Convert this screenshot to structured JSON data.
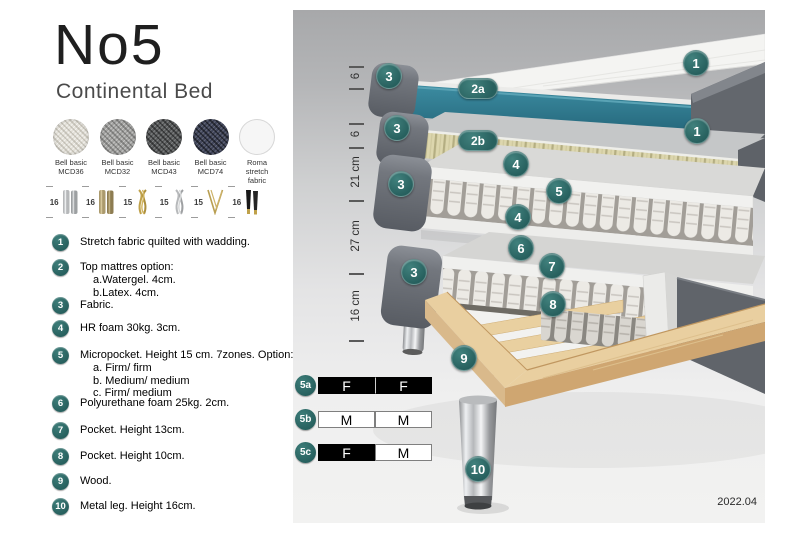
{
  "header": {
    "title": "No5",
    "subtitle": "Continental Bed"
  },
  "fabrics": [
    {
      "name": "Bell basic",
      "code": "MCD36"
    },
    {
      "name": "Bell basic",
      "code": "MCD32"
    },
    {
      "name": "Bell basic",
      "code": "MCD43"
    },
    {
      "name": "Bell basic",
      "code": "MCD74"
    },
    {
      "name": "Roma",
      "code": "stretch fabric"
    }
  ],
  "legs": [
    {
      "height": "16",
      "style": "chrome cylinder"
    },
    {
      "height": "16",
      "style": "bronze cylinder"
    },
    {
      "height": "15",
      "style": "gold twist"
    },
    {
      "height": "15",
      "style": "silver twist"
    },
    {
      "height": "15",
      "style": "gold hairpin"
    },
    {
      "height": "16",
      "style": "black with gold tip"
    }
  ],
  "list": [
    {
      "num": "1",
      "text": "Stretch fabric quilted with wadding."
    },
    {
      "num": "2",
      "text": "Top mattres option:",
      "sub": [
        "a.Watergel. 4cm.",
        "b.Latex. 4cm."
      ]
    },
    {
      "num": "3",
      "text": "Fabric."
    },
    {
      "num": "4",
      "text": "HR foam 30kg. 3cm."
    },
    {
      "num": "5",
      "text": "Micropocket. Height 15 cm. 7zones. Option:",
      "sub": [
        "a. Firm/ firm",
        "b. Medium/ medium",
        "c. Firm/ medium"
      ]
    },
    {
      "num": "6",
      "text": "Polyurethane foam 25kg. 2cm."
    },
    {
      "num": "7",
      "text": "Pocket. Height 13cm."
    },
    {
      "num": "8",
      "text": "Pocket. Height 10cm."
    },
    {
      "num": "9",
      "text": "Wood."
    },
    {
      "num": "10",
      "text": "Metal leg. Height 16cm."
    }
  ],
  "diagram": {
    "measurements": {
      "m1": "6",
      "m2": "6",
      "m3": "21 cm",
      "m4": "27 cm",
      "m5": "16 cm"
    },
    "badges": {
      "b1a": "1",
      "b1b": "1",
      "b2a": "2a",
      "b2b": "2b",
      "b3a": "3",
      "b3b": "3",
      "b3c": "3",
      "b3d": "3",
      "b4a": "4",
      "b4b": "4",
      "b5": "5",
      "b6": "6",
      "b7": "7",
      "b8": "8",
      "b9": "9",
      "b10": "10"
    },
    "firmness": {
      "rows": [
        {
          "label": "5a",
          "c1": "F",
          "c2": "F"
        },
        {
          "label": "5b",
          "c1": "M",
          "c2": "M"
        },
        {
          "label": "5c",
          "c1": "F",
          "c2": "M"
        }
      ]
    },
    "version": "2022.04"
  },
  "colors": {
    "accent_teal": "#2d6b69",
    "watergel_teal": "#2f7e95",
    "latex_cream": "#dcd6ad",
    "wood": "#e9cfa0"
  }
}
